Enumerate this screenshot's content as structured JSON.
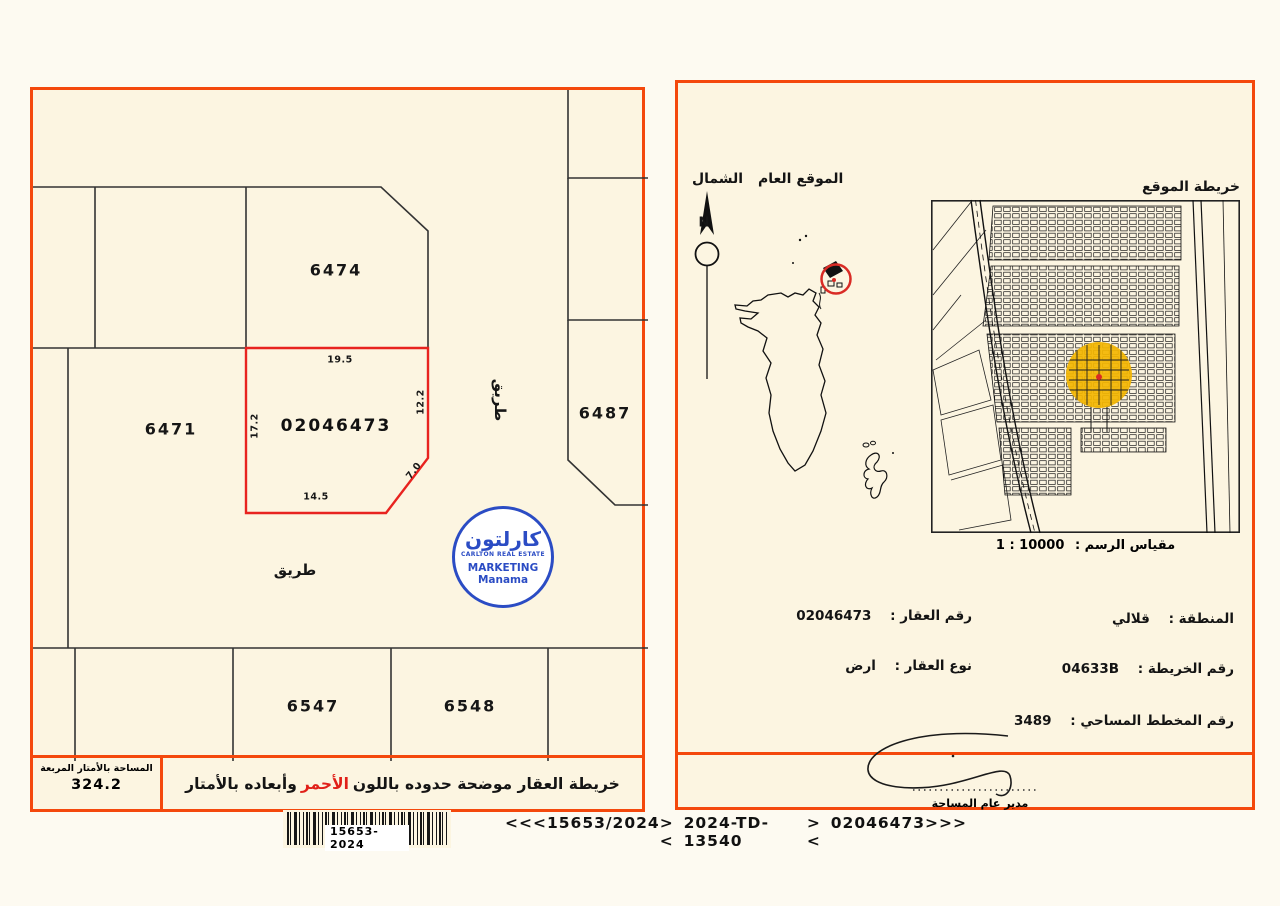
{
  "left_panel": {
    "parcels": [
      {
        "id": "6474"
      },
      {
        "id": "6471"
      },
      {
        "id": "6487"
      },
      {
        "id": "6547"
      },
      {
        "id": "6548"
      }
    ],
    "subject_parcel": {
      "number": "02046473",
      "dim_top": "19.5",
      "dim_left": "17.2",
      "dim_right": "12.2",
      "dim_diagonal": "7.0",
      "dim_bottom": "14.5"
    },
    "road_label_h": "طريق",
    "road_label_v": "طريق",
    "area_box": {
      "label": "المساحة بالأمتار المربعة",
      "value": "324.2"
    },
    "caption": {
      "prefix": "خريطة العقار موضحة حدوده باللون ",
      "highlight": "الأحمر",
      "suffix": " وأبعاده بالأمتار"
    },
    "barcode_text": "15653-2024"
  },
  "logo": {
    "arabic": "كارلتون",
    "subtitle": "CARLTON REAL ESTATE",
    "line2": "MARKETING",
    "line3": "Manama"
  },
  "right_panel": {
    "north_label": "الشمال",
    "compass_letter": "N",
    "general_location_label": "الموقع العام",
    "location_map_label": "خريطة الموقع",
    "scale_label": "مقياس الرسم :",
    "scale_value": "1 : 10000",
    "details": {
      "region_label": "المنطقة :",
      "region_value": "قلالي",
      "map_no_label": "رقم الخريطة :",
      "map_no_value": "04633B",
      "survey_plan_label": "رقم المخطط المساحي :",
      "survey_plan_value": "3489",
      "property_no_label": "رقم العقار :",
      "property_no_value": "02046473",
      "property_type_label": "نوع العقار :",
      "property_type_value": "ارض"
    },
    "signature_title": "مدير عام المساحة"
  },
  "footer": {
    "codes": [
      "<<<",
      "15653/2024",
      "><",
      "2024-TD-13540",
      "><",
      "02046473",
      ">>>"
    ]
  },
  "colors": {
    "border_orange": "#f4480c",
    "plot_red": "#e8231f",
    "logo_blue": "#2b4cc4",
    "highlight_yellow": "#f3b602"
  }
}
